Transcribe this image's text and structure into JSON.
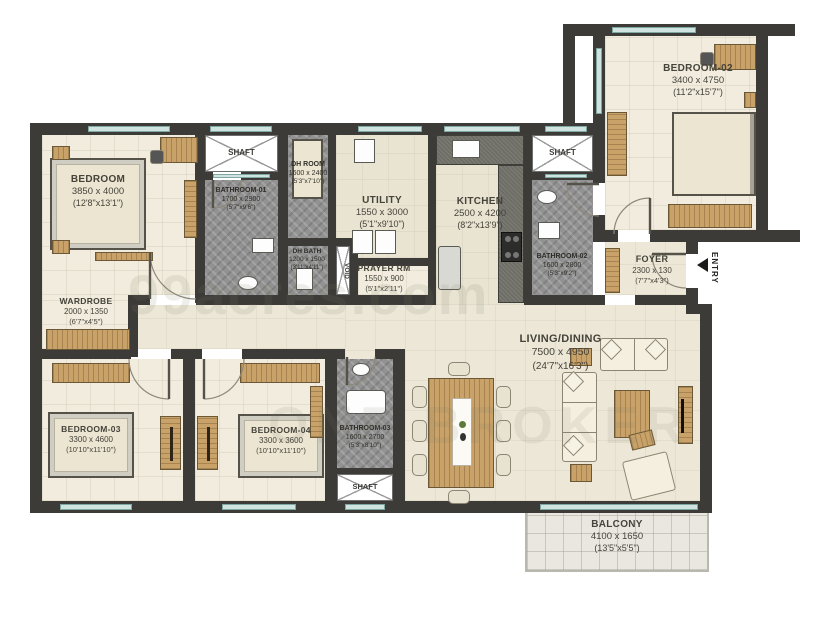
{
  "plan": {
    "entry_label": "ENTRY",
    "watermark": {
      "primary": "99acres.com",
      "secondary": "ONE BROKER"
    },
    "rooms": {
      "master_bedroom": {
        "name": "BEDROOM",
        "dim_mm": "3850 x 4000",
        "dim_ft": "(12'8\"x13'1\")"
      },
      "wardrobe": {
        "name": "WARDROBE",
        "dim_mm": "2000 x 1350",
        "dim_ft": "(6'7\"x4'5\")"
      },
      "shaft_nw": {
        "name": "SHAFT"
      },
      "bathroom_01": {
        "name": "BATHROOM-01",
        "dim_mm": "1700 x 2900",
        "dim_ft": "(5'7\"x9'6\")"
      },
      "dh_room": {
        "name": "DH ROOM",
        "dim_mm": "1600 x 2400",
        "dim_ft": "(5'3\"x7'10\")"
      },
      "dh_bath": {
        "name": "DH BATH",
        "dim_mm": "1200 x 1500",
        "dim_ft": "(3'11\"x4'11\")"
      },
      "void": {
        "name": "VOID"
      },
      "utility": {
        "name": "UTILITY",
        "dim_mm": "1550 x 3000",
        "dim_ft": "(5'1\"x9'10\")"
      },
      "prayer_room": {
        "name": "PRAYER RM",
        "dim_mm": "1550 x 900",
        "dim_ft": "(5'1\"x2'11\")"
      },
      "kitchen": {
        "name": "KITCHEN",
        "dim_mm": "2500 x 4200",
        "dim_ft": "(8'2\"x13'9\")"
      },
      "shaft_ne": {
        "name": "SHAFT"
      },
      "bathroom_02": {
        "name": "BATHROOM-02",
        "dim_mm": "1600 x 2800",
        "dim_ft": "(5'3\"x9'2\")"
      },
      "foyer": {
        "name": "FOYER",
        "dim_mm": "2300 x 130",
        "dim_ft": "(7'7\"x4'3\")"
      },
      "bedroom_02": {
        "name": "BEDROOM-02",
        "dim_mm": "3400 x 4750",
        "dim_ft": "(11'2\"x15'7\")"
      },
      "living_dining": {
        "name": "LIVING/DINING",
        "dim_mm": "7500 x 4950",
        "dim_ft": "(24'7\"x16'3\")"
      },
      "bedroom_03": {
        "name": "BEDROOM-03",
        "dim_mm": "3300 x 4600",
        "dim_ft": "(10'10\"x11'10\")"
      },
      "bedroom_04": {
        "name": "BEDROOM-04",
        "dim_mm": "3300 x 3600",
        "dim_ft": "(10'10\"x11'10\")"
      },
      "bathroom_03": {
        "name": "BATHROOM-03",
        "dim_mm": "1600 x 2700",
        "dim_ft": "(5'3\"x8'10\")"
      },
      "shaft_s": {
        "name": "SHAFT"
      },
      "balcony": {
        "name": "BALCONY",
        "dim_mm": "4100 x 1650",
        "dim_ft": "(13'5\"x5'5\")"
      }
    },
    "colors": {
      "wall": "#3c3b38",
      "window": "#cfe4e0",
      "wood": "#c8a269",
      "bath_floor": "#929292",
      "room_floor": "#f1ecdd",
      "accent_text": "#45433a"
    }
  }
}
